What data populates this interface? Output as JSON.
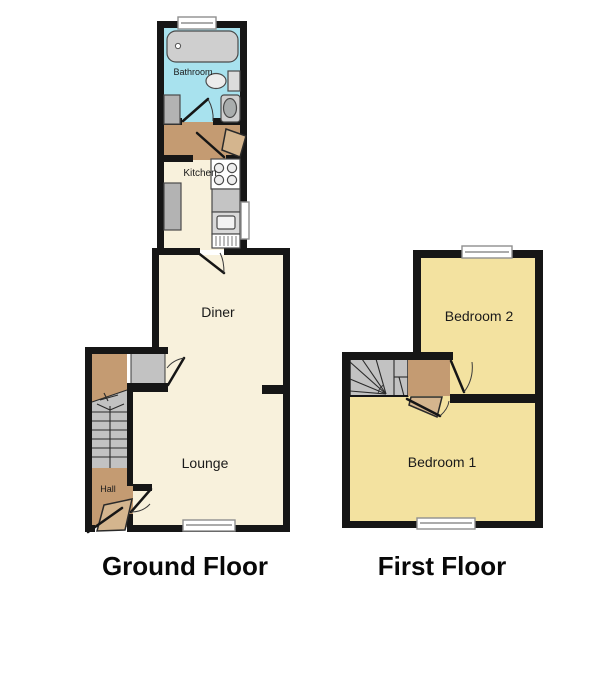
{
  "ground_floor": {
    "title": "Ground Floor",
    "rooms": {
      "bathroom": "Bathroom",
      "kitchen": "Kitchen",
      "diner": "Diner",
      "lounge": "Lounge",
      "hall": "Hall"
    }
  },
  "first_floor": {
    "title": "First Floor",
    "rooms": {
      "bedroom2": "Bedroom 2",
      "bedroom1": "Bedroom 1"
    }
  },
  "colors": {
    "background": "#ffffff",
    "wall": "#161616",
    "cream": "#f8f1dc",
    "bathroom_blue": "#a8e2ee",
    "tan": "#c49b72",
    "door_leaf": "#d4b58e",
    "bedroom_yellow": "#f3e2a0",
    "stair_gray": "#c2c2c2",
    "fixture_gray": "#cfcfcf",
    "window_white": "#ffffff"
  }
}
